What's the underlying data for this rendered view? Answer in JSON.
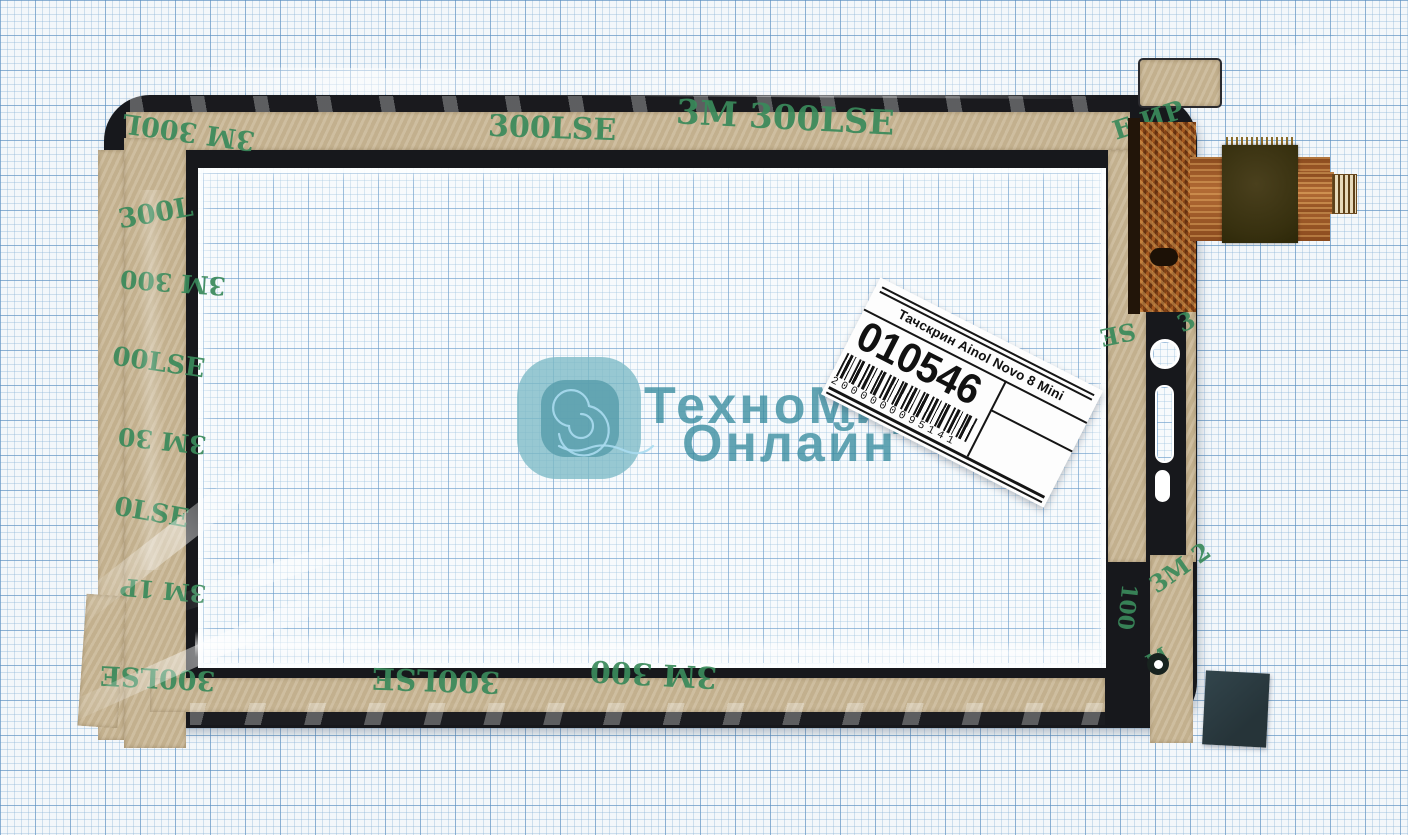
{
  "photo": {
    "subject": "touchscreen-digitizer-ainol-novo-8-mini",
    "background": "blue millimeter graph paper"
  },
  "label": {
    "title": "Тачскрин Ainol Novo 8 Mini",
    "sku": "010546",
    "barcode_digits": "2000000095141"
  },
  "watermark": {
    "line1": "ТехноМир",
    "line2": "Онлайн"
  },
  "tape_brand": "3M 300LSE",
  "tape_fragments": [
    {
      "text": "3M 300LSE",
      "x": 676,
      "y": 101,
      "rot": 3,
      "size": 34
    },
    {
      "text": "300LSE",
      "x": 488,
      "y": 114,
      "rot": 2,
      "size": 30
    },
    {
      "text": "3M 300L",
      "x": 122,
      "y": 118,
      "rot": 188,
      "size": 27
    },
    {
      "text": "300L",
      "x": 118,
      "y": 200,
      "rot": -10,
      "size": 27
    },
    {
      "text": "3M 300",
      "x": 120,
      "y": 270,
      "rot": 184,
      "size": 25
    },
    {
      "text": "00LSE",
      "x": 112,
      "y": 350,
      "rot": 8,
      "size": 26
    },
    {
      "text": "3M 30",
      "x": 118,
      "y": 428,
      "rot": 186,
      "size": 25
    },
    {
      "text": "0LSE",
      "x": 114,
      "y": 500,
      "rot": 10,
      "size": 26
    },
    {
      "text": "3M 1P",
      "x": 120,
      "y": 578,
      "rot": 185,
      "size": 24
    },
    {
      "text": "300LSE",
      "x": 100,
      "y": 664,
      "rot": 183,
      "size": 27
    },
    {
      "text": "300LSE",
      "x": 372,
      "y": 664,
      "rot": 182,
      "size": 30
    },
    {
      "text": "3M 300",
      "x": 590,
      "y": 658,
      "rot": 183,
      "size": 30
    },
    {
      "text": "Е ИР",
      "x": 1112,
      "y": 108,
      "rot": -18,
      "size": 26
    },
    {
      "text": "SE",
      "x": 1100,
      "y": 322,
      "rot": 168,
      "size": 24
    },
    {
      "text": "3",
      "x": 1178,
      "y": 310,
      "rot": -25,
      "size": 24
    },
    {
      "text": "3M 2",
      "x": 1146,
      "y": 556,
      "rot": -35,
      "size": 24
    },
    {
      "text": "100",
      "x": 1104,
      "y": 596,
      "rot": 96,
      "size": 22
    },
    {
      "text": "M",
      "x": 1146,
      "y": 648,
      "rot": -30,
      "size": 20
    }
  ],
  "colors": {
    "paper": "#f3f7fa",
    "grid_minor": "#bcd6e8",
    "grid_major": "#6fa0cb",
    "tape": "#c9b795",
    "tape_print_green": "#3a8a5b",
    "panel_frame": "#17181c",
    "flex_copper": "#a4581f",
    "flex_stiffener": "#3e3517",
    "watermark_teal": "#388ea0",
    "corner_pad": "#2a3b41"
  }
}
